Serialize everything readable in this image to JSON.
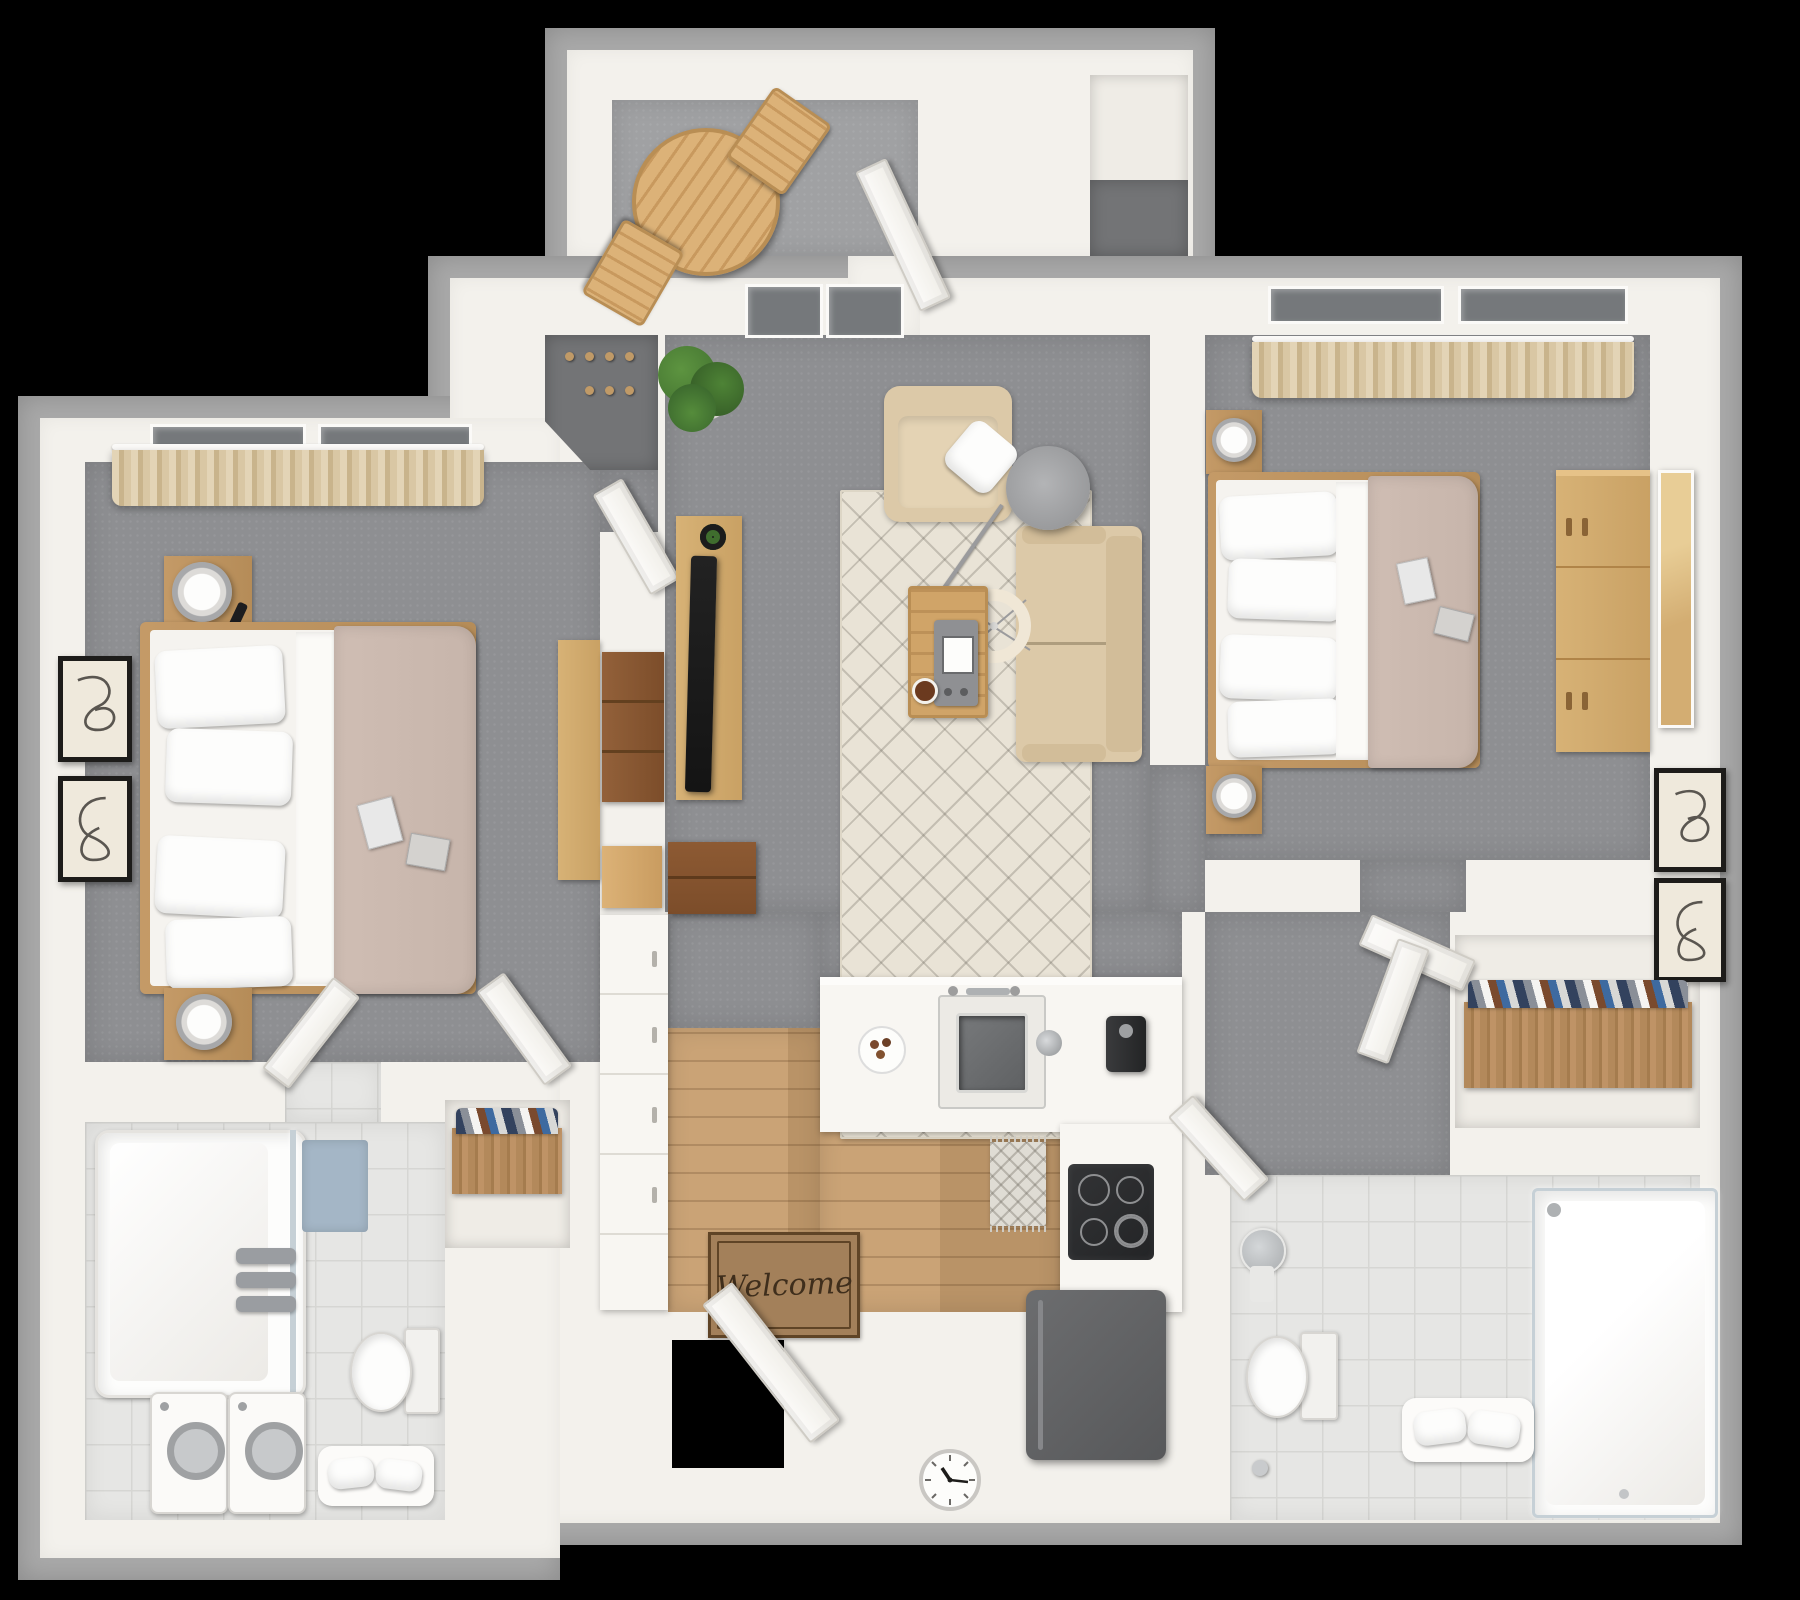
{
  "image_type": "3d-floor-plan-top-down-render",
  "visible_text": {
    "welcome_mat": "Welcome"
  },
  "palette": {
    "background": "#000000",
    "outer_wall": "#a9a9a9",
    "wall": "#f3f1ec",
    "carpet": "#8e8f92",
    "carpet_balcony": "#a0a1a3",
    "nook_floor": "#737476",
    "closet_floor": "#efece6",
    "wood_floor_a": "#c79e6f",
    "tile_floor": "#e6e6e4",
    "tile_line": "#d6d6d3",
    "counter_white": "#f8f6f2",
    "furniture_wood": "#d7b276",
    "wood_mid": "#c49a67",
    "cabinet_dark": "#7c4d2a",
    "appliance_dark": "#57585a",
    "sofa_beige": "#dcc9a8",
    "duvet_taupe": "#c7b5ab",
    "pillow_white": "#fdfdfc",
    "rug_cream": "#e9e3d6",
    "curtain_tan": "#d9c7a4",
    "glass": "#c6d0d6",
    "towel_gray": "#9a9da1",
    "mat_blue": "#a4b6c6",
    "mat_brown": "#a3805a",
    "mat_border": "#5f4426",
    "mat_text": "#3f2e1c",
    "art_paper": "#efe9dc",
    "frame_black": "#1d1c1a",
    "plant_green": "#41702f",
    "pendant_cream": "#f0e7d6",
    "lamp_gray": "#a7a8aa",
    "tv_black": "#141414"
  },
  "rooms": [
    {
      "id": "balcony",
      "label": "Balcony",
      "floor": "outdoor carpet",
      "items": [
        "round slat bistro table",
        "folding chair",
        "folding chair",
        "open balcony door"
      ]
    },
    {
      "id": "storage-closet",
      "label": "Exterior storage closet",
      "floor": "concrete",
      "items": []
    },
    {
      "id": "bedroom-1",
      "label": "Bedroom 1",
      "floor": "carpet",
      "items": [
        "window curtains",
        "nightstand with lamp and remote",
        "queen bed with white pillows and taupe duvet",
        "magazines on bed",
        "second nightstand with lamp",
        "two framed line artworks",
        "desk",
        "door to bathroom",
        "door to hallway"
      ]
    },
    {
      "id": "entry-nook",
      "label": "Coat nook",
      "floor": "dark carpet",
      "items": [
        "wall peg hooks",
        "nook door"
      ]
    },
    {
      "id": "living-room",
      "label": "Living room",
      "floor": "carpet",
      "items": [
        "potted plant",
        "media console with TV",
        "dark wood cabinet",
        "armchair with throw pillow",
        "sofa",
        "arc floor lamp",
        "ring pendant light",
        "coffee table with tray and coffee",
        "patterned area rug"
      ]
    },
    {
      "id": "bedroom-2",
      "label": "Bedroom 2",
      "floor": "carpet",
      "items": [
        "window curtains",
        "nightstand with lamp",
        "queen bed with white pillows and taupe duvet",
        "magazines on bed",
        "second nightstand with lamp",
        "dresser",
        "leaning mirror",
        "two framed line artworks"
      ]
    },
    {
      "id": "kitchen",
      "label": "Kitchen / entry",
      "floor": "wood plank",
      "items": [
        "dark upper cabinet",
        "side cabinet",
        "counter with drawers",
        "island with sink and faucet",
        "plate of cookies",
        "coffee maker",
        "cooktop counter",
        "refrigerator",
        "runner rug",
        "welcome mat",
        "open front door",
        "wall clock"
      ]
    },
    {
      "id": "bathroom-1",
      "label": "Bathroom 1 / laundry",
      "floor": "tile",
      "items": [
        "tub shower with glass panel",
        "gray towels",
        "blue bath mat",
        "toilet",
        "toilet paper stand",
        "washer",
        "dryer",
        "bench with towels",
        "shoe closet with rack"
      ]
    },
    {
      "id": "hallway",
      "label": "Hallway",
      "floor": "carpet",
      "items": [
        "bedroom 2 door",
        "bathroom 2 door",
        "closet door"
      ]
    },
    {
      "id": "bathroom-2",
      "label": "Bathroom 2",
      "floor": "tile",
      "items": [
        "pedestal sink",
        "toilet",
        "toilet paper stand",
        "glass shower",
        "towels on bench",
        "walk-in closet with shoe rack"
      ]
    }
  ]
}
